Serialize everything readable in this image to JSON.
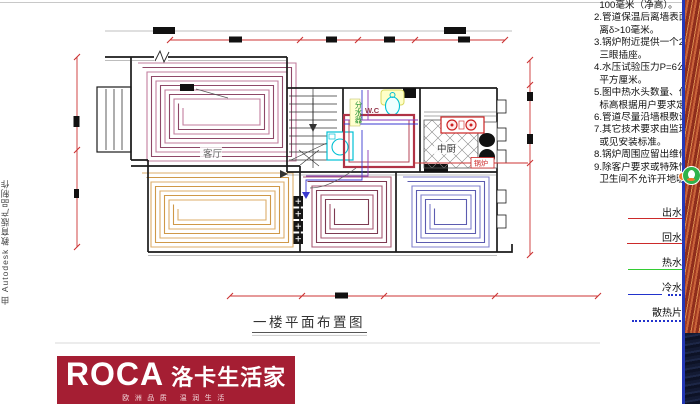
{
  "watermark": {
    "text": "由 Autodesk 教育版产品制作"
  },
  "notes": {
    "lines": [
      "  100毫米（净高）。",
      "2.管道保温后离墙表面",
      "  离δ>10毫米。",
      "3.锅炉附近提供一个2",
      "  三眼插座。",
      "4.水压试验压力P=6公",
      "  平方厘米。",
      "5.图中热水头数量、位",
      "  标高根据用户要求定",
      "6.管道尽量沿墙根敷设",
      "7.其它技术要求由监理",
      "  或见安装标准。",
      "8.锅炉周围应留出维修",
      "9.除客户要求或特殊情",
      "  卫生间不允许开地暖"
    ]
  },
  "plan": {
    "title": "一楼平面布置图",
    "labels": {
      "living": "客厅",
      "kitchen": "中厨",
      "wc": "W.C",
      "boiler": "锅炉",
      "manifold": "分水器"
    },
    "coil_colors": {
      "living": [
        "#c27d9e",
        "#8e4868"
      ],
      "dining": [
        "#dcae6a",
        "#cf9848"
      ],
      "middle": [
        "#a85a74",
        "#7d3a52"
      ],
      "right": [
        "#8080cc",
        "#5c5cb0"
      ]
    },
    "dimension_color": "#cc3333"
  },
  "legend": {
    "items": [
      {
        "label": "出水",
        "color": "#cc2a2a",
        "style": "solid"
      },
      {
        "label": "回水",
        "color": "#cc2a2a",
        "style": "solid"
      },
      {
        "label": "热水",
        "color": "#33cc33",
        "style": "solid"
      },
      {
        "label": "冷水",
        "color": "#2233cc",
        "style": "dashed"
      },
      {
        "label": "散热片",
        "color": "#2233cc",
        "style": "dotted"
      }
    ]
  },
  "logo": {
    "brand": "ROCA",
    "brand_cn": "洛卡生活家",
    "tagline": "欧洲品质 温润生活"
  }
}
